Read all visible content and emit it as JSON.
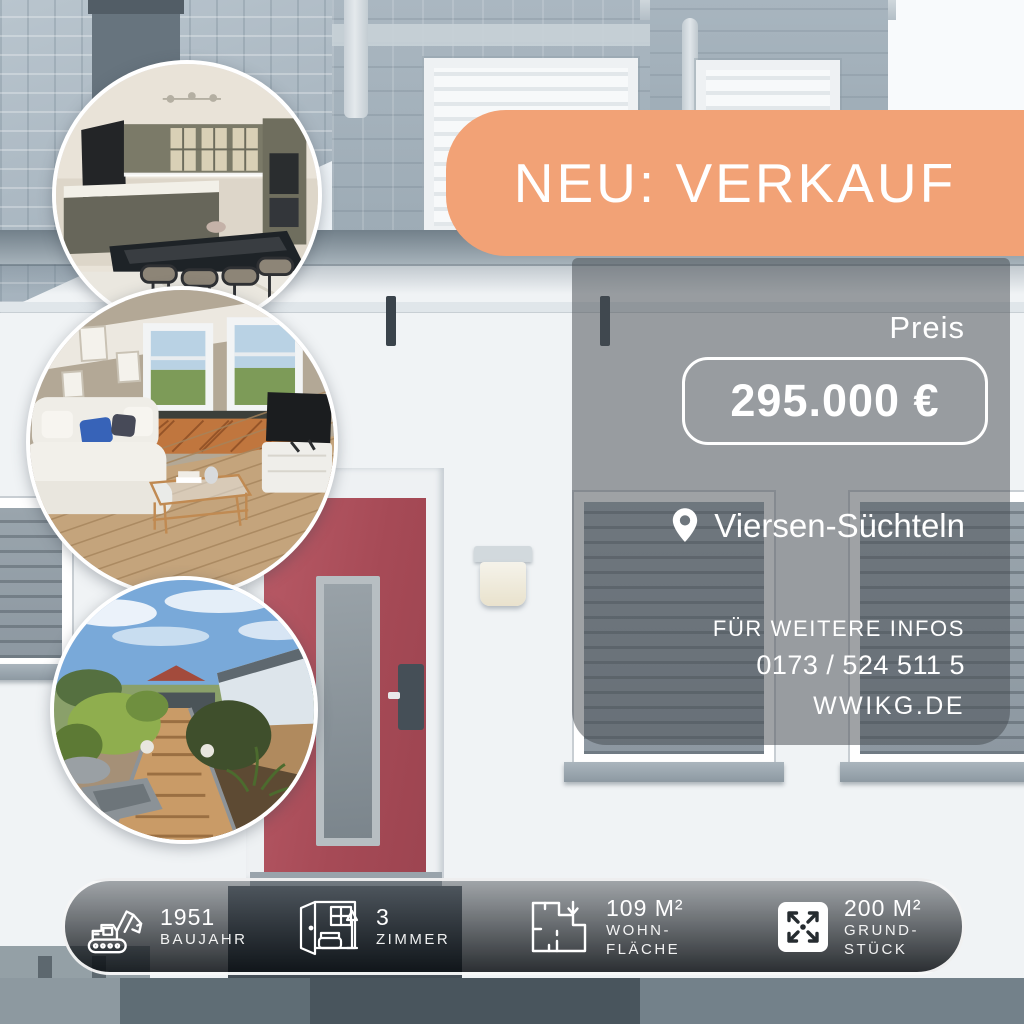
{
  "banner": {
    "label": "NEU: VERKAUF"
  },
  "price_panel": {
    "heading": "Preis",
    "price": "295.000 €",
    "location": "Viersen-Süchteln",
    "info_title": "FÜR WEITERE INFOS",
    "phone": "0173 / 524 511 5",
    "website": "WWIKG.DE"
  },
  "stats": [
    {
      "icon": "excavator-icon",
      "value": "1951",
      "label1": "BAUJAHR",
      "label2": ""
    },
    {
      "icon": "room-icon",
      "value": "3",
      "label1": "ZIMMER",
      "label2": ""
    },
    {
      "icon": "floorplan-icon",
      "value": "109 M²",
      "label1": "WOHN-",
      "label2": "FLÄCHE"
    },
    {
      "icon": "expand-arrows-icon",
      "value": "200 M²",
      "label1": "GRUND-",
      "label2": "STÜCK"
    }
  ],
  "photo_circles": [
    {
      "name": "kitchen-photo"
    },
    {
      "name": "living-room-photo"
    },
    {
      "name": "garden-photo"
    }
  ],
  "colors": {
    "accent_orange": "#F2A276",
    "overlay_panel_gray": "#747A80",
    "door_red": "#A64A56",
    "text_white": "#FFFFFF"
  }
}
